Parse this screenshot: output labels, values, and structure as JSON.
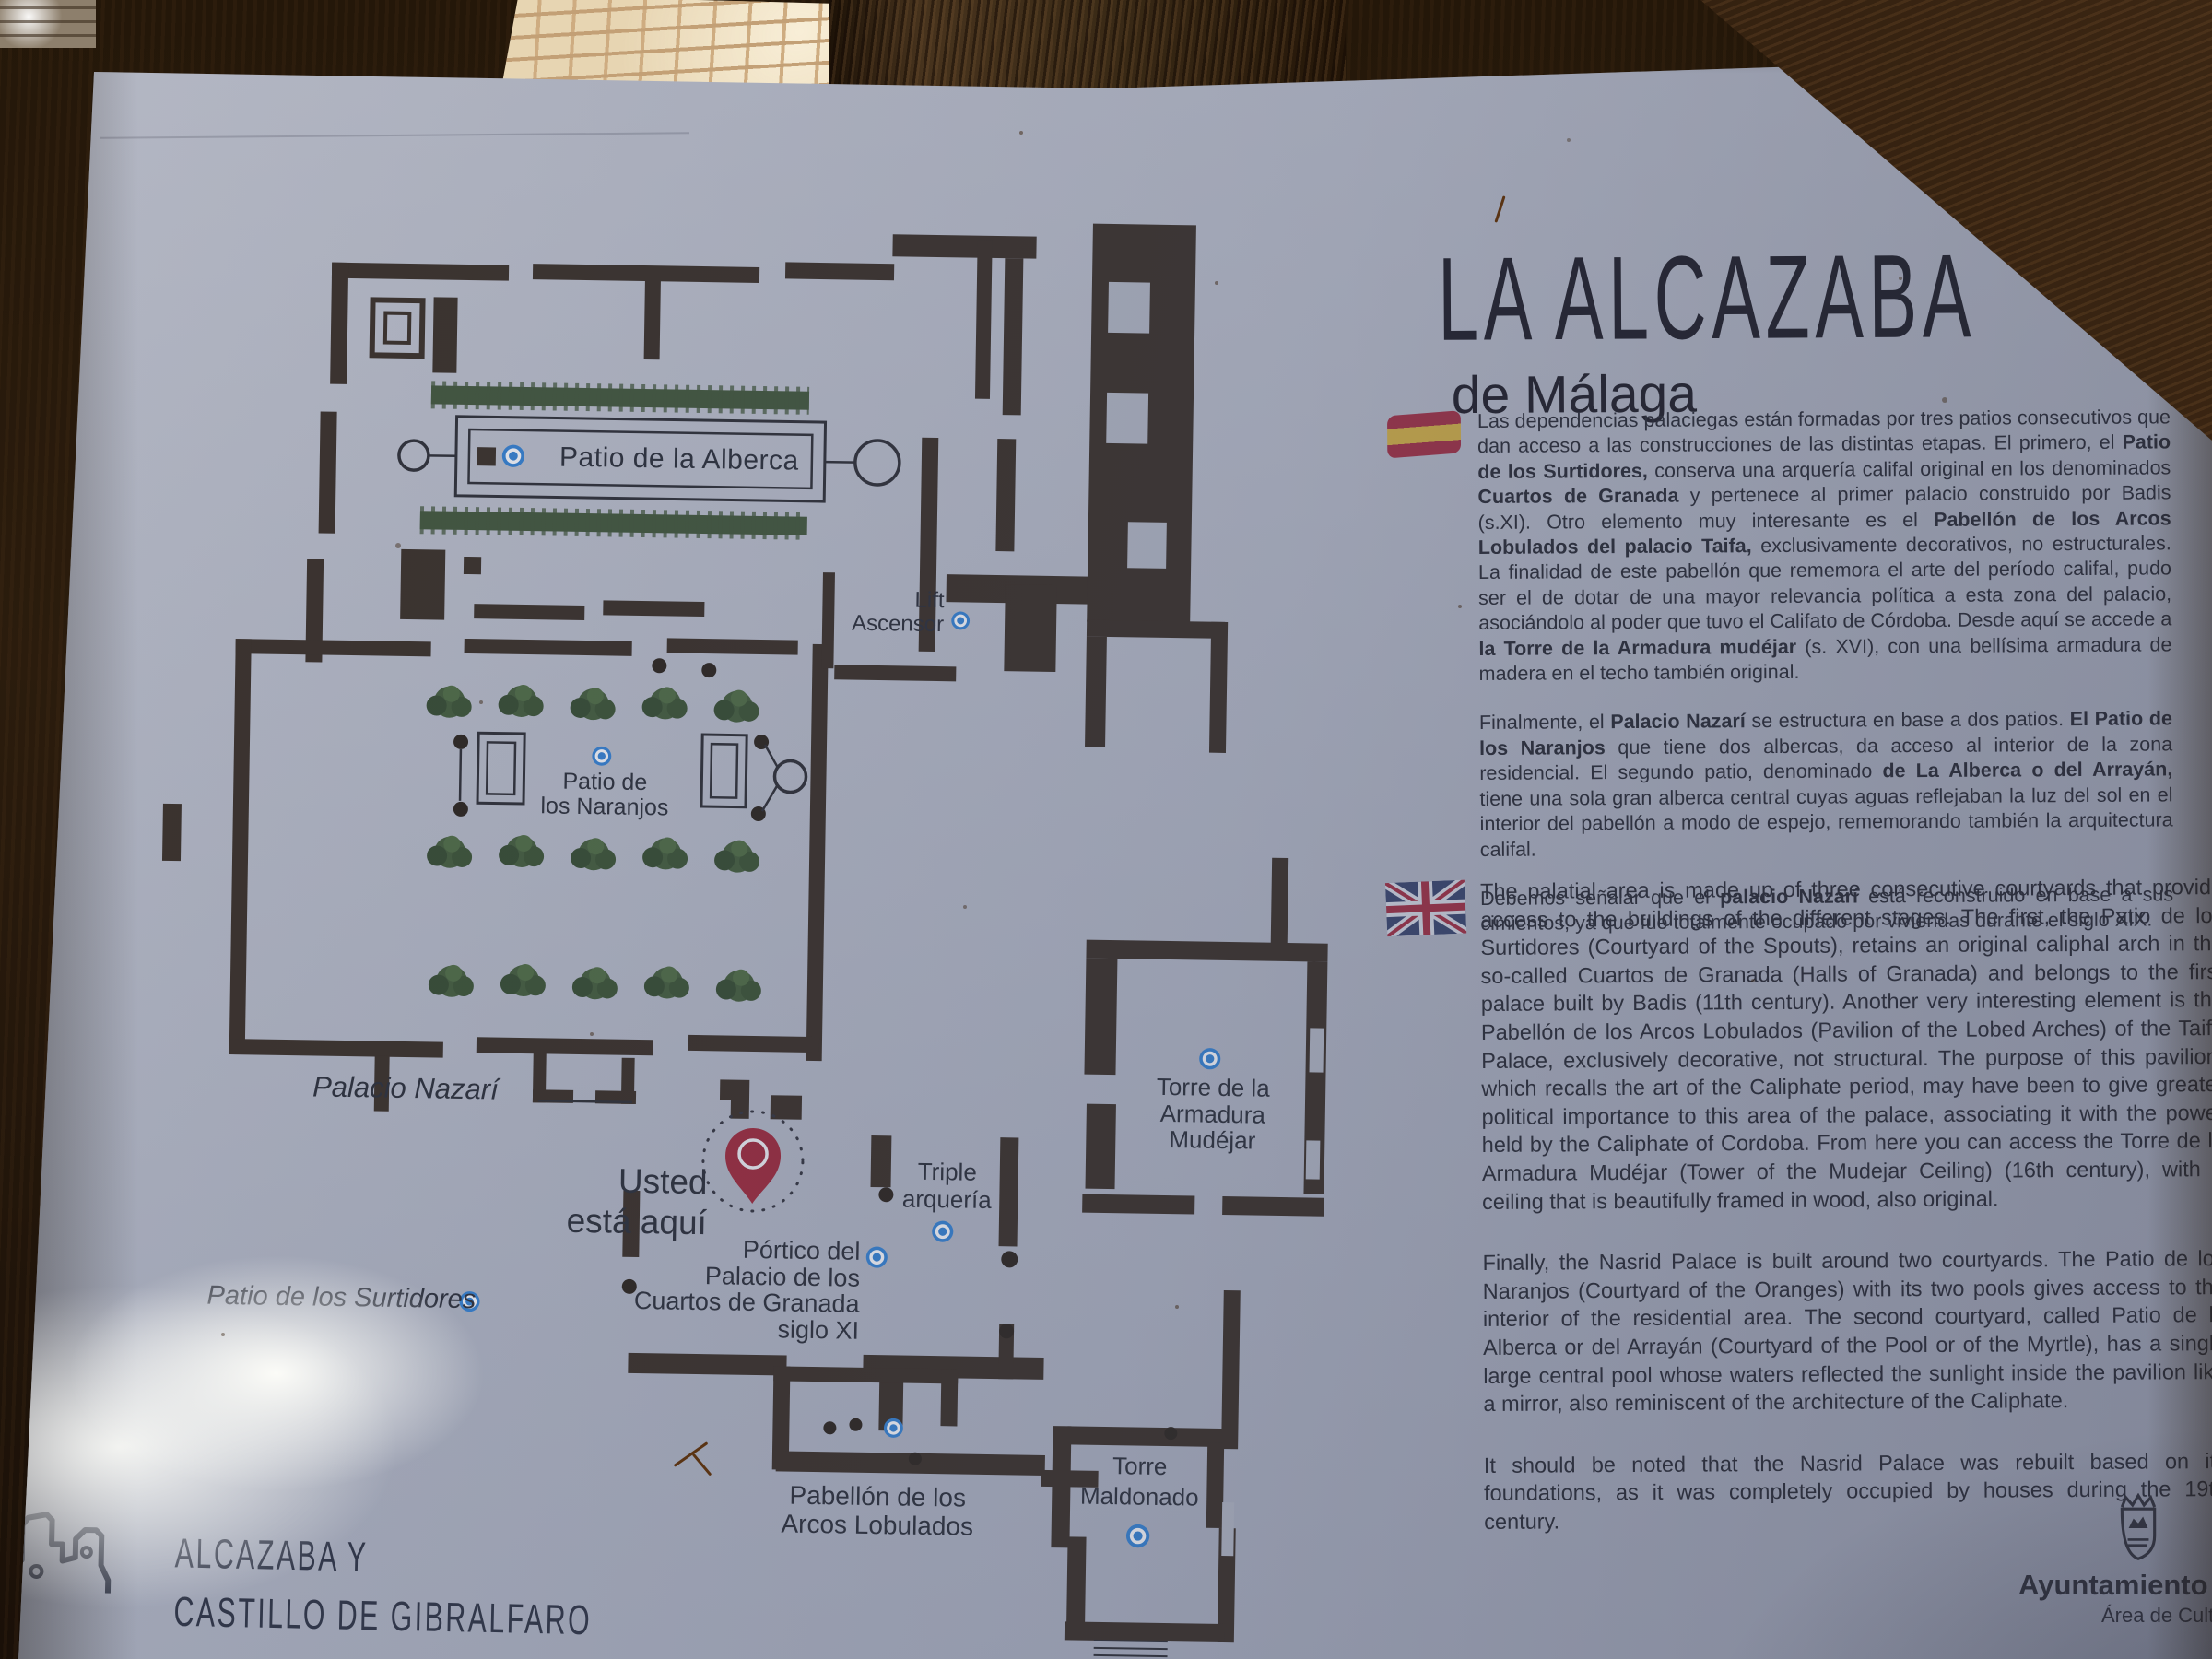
{
  "sign": {
    "title": "LA ALCAZABA",
    "subtitle": "de Málaga",
    "spanish": {
      "paragraphs": [
        [
          {
            "t": "Las dependencias palaciegas están formadas por tres patios consecutivos que dan acceso a las construcciones de las distintas etapas. El primero, el "
          },
          {
            "t": "Patio de los Surtidores,",
            "b": true
          },
          {
            "t": " conserva una arquería califal original en los denominados "
          },
          {
            "t": "Cuartos de Granada",
            "b": true
          },
          {
            "t": " y pertenece al primer palacio construido por Badis (s.XI). Otro elemento muy interesante es el "
          },
          {
            "t": "Pabellón de los Arcos Lobulados del palacio Taifa,",
            "b": true
          },
          {
            "t": " exclusivamente decorativos, no estructurales. La finalidad de este pabellón que rememora el arte del período califal, pudo ser el de dotar de una mayor relevancia política a esta zona del palacio, asociándolo al poder que tuvo el Califato de Córdoba. Desde aquí se accede a "
          },
          {
            "t": "la Torre de la Armadura mudéjar",
            "b": true
          },
          {
            "t": " (s. XVI), con una bellísima armadura de madera en el techo también original."
          }
        ],
        [
          {
            "t": "Finalmente, el "
          },
          {
            "t": "Palacio Nazarí",
            "b": true
          },
          {
            "t": " se estructura en base a dos patios. "
          },
          {
            "t": "El Patio de los Naranjos",
            "b": true
          },
          {
            "t": " que tiene dos albercas, da acceso al interior de la zona residencial. El segundo patio, denominado "
          },
          {
            "t": "de La Alberca o del Arrayán,",
            "b": true
          },
          {
            "t": " tiene una sola gran alberca central cuyas aguas reflejaban la luz del sol en el interior del pabellón a modo de espejo, rememorando también la arquitectura califal."
          }
        ],
        [
          {
            "t": "Debemos señalar que el "
          },
          {
            "t": "palacio Nazarí",
            "b": true
          },
          {
            "t": " está reconstruido en base a sus cimientos, ya que fue totalmente ocupado por viviendas durante el siglo XIX."
          }
        ]
      ]
    },
    "english": {
      "paragraphs": [
        "The palatial area is made up of three consecutive courtyards that provide access to the buildings of the different stages. The first, the Patio de los Surtidores (Courtyard of the Spouts), retains an original caliphal arch in the so-called Cuartos de Granada (Halls of Granada) and belongs to the first palace built by Badis (11th century). Another very interesting element is the Pabellón de los Arcos Lobulados (Pavilion of the Lobed Arches) of the Taifa Palace, exclusively decorative, not structural. The purpose of this pavilion, which recalls the art of the Caliphate period, may have been to give greater political importance to this area of the palace, associating it with the power held by the Caliphate of Cordoba. From here you can access the Torre de la Armadura Mudéjar (Tower of the Mudejar Ceiling) (16th century), with a ceiling that is beautifully framed in wood, also original.",
        "Finally, the Nasrid Palace is built around two courtyards. The Patio de los Naranjos (Courtyard of the Oranges) with its two pools gives access to the interior of the residential area. The second courtyard, called Patio de la Alberca or del Arrayán (Courtyard of the Pool or of the Myrtle), has a single large central pool whose waters reflected the sunlight inside the pavilion like a mirror, also reminiscent of the architecture of the Caliphate.",
        "It should be noted that the Nasrid Palace was rebuilt based on its foundations, as it was completely occupied by houses during the 19th century."
      ]
    },
    "map": {
      "labels": {
        "patio_alberca": {
          "lines": [
            "Patio de la Alberca"
          ]
        },
        "lift": {
          "lines": [
            "Lift",
            "Ascensor"
          ]
        },
        "patio_naranjos": {
          "lines": [
            "Patio de",
            "los Naranjos"
          ]
        },
        "palacio_nazari": {
          "lines": [
            "Palacio Nazarí"
          ]
        },
        "usted": {
          "lines": [
            "Usted",
            "está aquí"
          ]
        },
        "triple_arqueria": {
          "lines": [
            "Triple",
            "arquería"
          ]
        },
        "portico": {
          "lines": [
            "Pórtico del",
            "Palacio de los",
            "Cuartos de Granada",
            "siglo XI"
          ]
        },
        "patio_surtidores": {
          "lines": [
            "Patio de los Surtidores"
          ]
        },
        "torre_armadura": {
          "lines": [
            "Torre de la",
            "Armadura",
            "Mudéjar"
          ]
        },
        "pabellon": {
          "lines": [
            "Pabellón de los",
            "Arcos Lobulados"
          ]
        },
        "torre_maldonado": {
          "lines": [
            "Torre",
            "Maldonado"
          ]
        }
      },
      "icons": {
        "poi_marker": "poi-marker-icon",
        "you_are_here": "you-are-here-pin-icon"
      }
    },
    "footer_left": {
      "lines": [
        "ALCAZABA Y",
        "CASTILLO DE GIBRALFARO"
      ],
      "icon": "castle-skyline-icon"
    },
    "footer_right": {
      "line1": "Ayuntamiento de M",
      "line2": "Área de Cultura",
      "icon": "city-crest-icon"
    },
    "colors": {
      "marker_blue": "#2e7fd2",
      "pin_red": "#9e2130",
      "wall_brown": "#33271b",
      "hedge_green": "#3c5130",
      "sign_base": "#b7bac4"
    }
  }
}
